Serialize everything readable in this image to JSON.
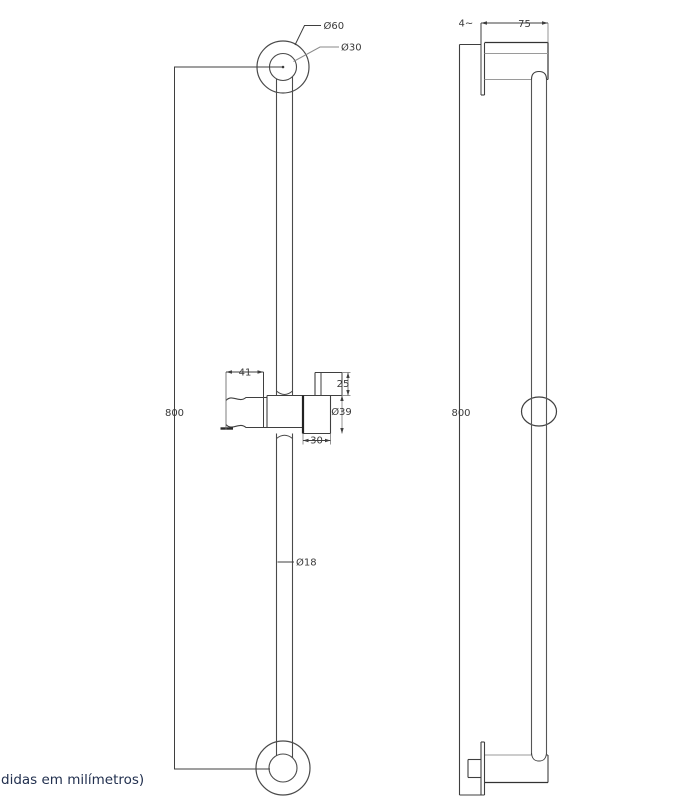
{
  "caption": {
    "text": "didas em milímetros)"
  },
  "front_view": {
    "labels": {
      "dia_outer": "Ø60",
      "dia_inner": "Ø30",
      "height": "800",
      "holder_length": "41",
      "top_knob_height": "25",
      "knob_diameter": "Ø39",
      "knob_depth": "30",
      "bar_diameter": "Ø18"
    }
  },
  "side_view": {
    "labels": {
      "plate_thickness": "4~",
      "escutcheon_width": "75",
      "height": "800"
    }
  },
  "colors": {
    "line": "#3f3f3f",
    "light_line": "#9a9a9a",
    "dimension_text": "#3a3a3a",
    "caption_text": "#22304f",
    "background": "#ffffff"
  }
}
